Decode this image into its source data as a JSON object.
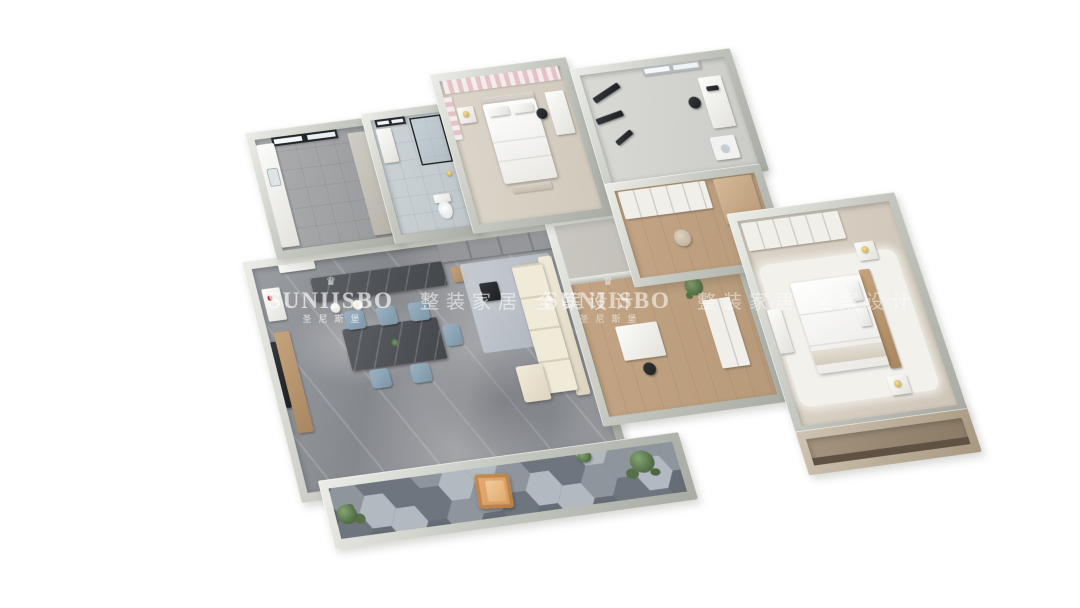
{
  "watermark": {
    "brand": "SUNIISBO",
    "brand_cn": "圣尼斯堡",
    "tagline": "整装家居 全案设计"
  },
  "palette": {
    "wall": "#c6c9c1",
    "wall_face": "#ecede8",
    "tile": "#ccd4d8",
    "pale": "#dcd5c9",
    "wood": "#c3a585",
    "sofa": "#ddd5c0",
    "chair_blue": "#7b97a9",
    "accent_orange": "#d6995f",
    "dark_marble": "#44474b",
    "pink": "#e3c3c6",
    "gold": "#c09a2a",
    "plant": "#4c6741",
    "hex_dark": "#6f757e",
    "hex_mid": "#8f959d",
    "hex_light": "#b3b9c1",
    "brown": "#8a7a66"
  },
  "scene": {
    "type": "3d-floor-plan-render",
    "rooms": [
      "living-dining-room",
      "kitchen",
      "bathroom",
      "bedroom-secondary",
      "study-gym",
      "closet-hallway",
      "study-room",
      "master-bedroom",
      "balcony",
      "master-balcony"
    ]
  }
}
